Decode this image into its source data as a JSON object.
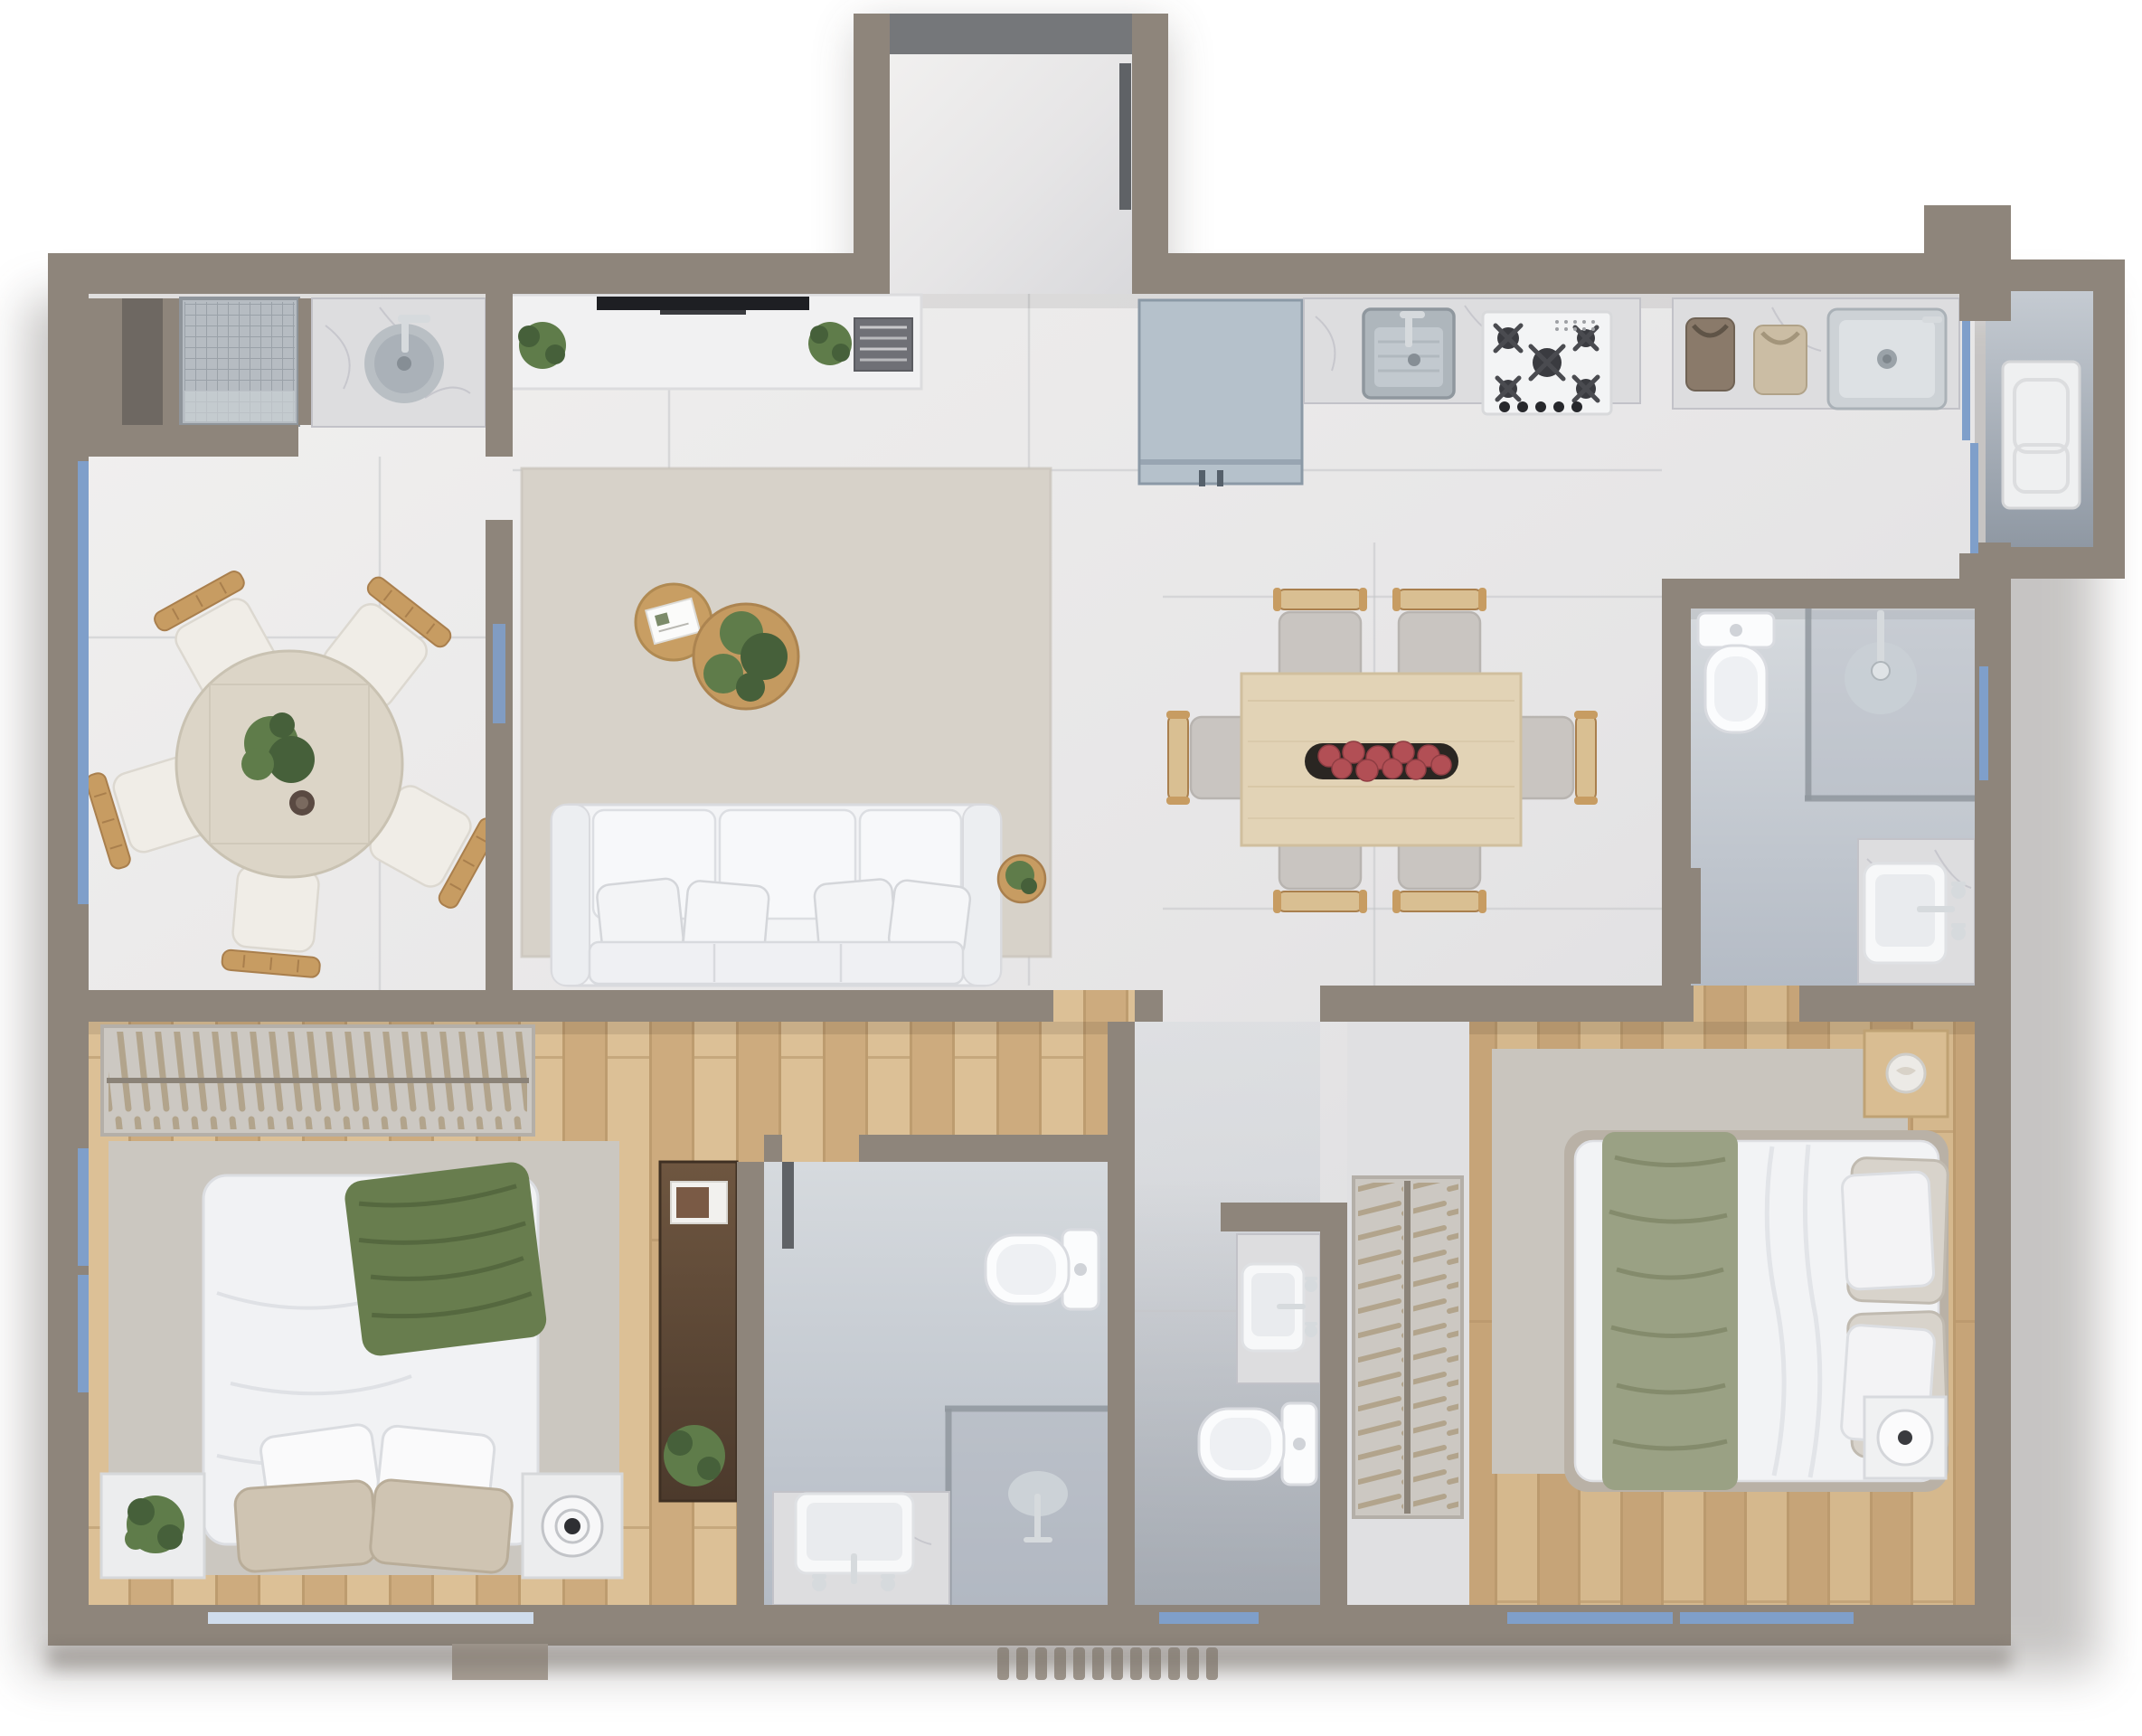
{
  "meta": {
    "title": "3D apartment floor plan – top-down architectural render",
    "view": "top-down",
    "style": "photorealistic 3d render, no text labels"
  },
  "palette": {
    "bg": "#ffffff",
    "shadow": "#55504b",
    "wall": "#8e857b",
    "wallLight": "#a59c92",
    "wallDark": "#756d66",
    "grout": "#c6c7ca",
    "tileA": "#f1f0ef",
    "tileB": "#d9d9dc",
    "bathA": "#d6dade",
    "bathB": "#b4bbc5",
    "balcA": "#c5cbd2",
    "balcB": "#8f98a3",
    "marble": "#dddddf",
    "marbleVein": "#c2c2c8",
    "wood": "#cdab7e",
    "woodLight": "#dcc096",
    "woodLine": "#b08f63",
    "wood2": "#c6a478",
    "wood2Light": "#d5b88d",
    "darkWoodA": "#6e5640",
    "darkWoodB": "#4c3a2c",
    "rugLiving": "#d7d2c9",
    "rugBed": "#cbc7c0",
    "rugMaster": "#c9c5be",
    "furnWhite": "#f3f4f6",
    "furnShadow": "#d9dade",
    "chrome": "#d6dadd",
    "glass": "#8f969e",
    "windowBlue": "#7f9fca",
    "windowPale": "#cfdcec",
    "plantGreen": "#5f7c4a",
    "plantDark": "#46603a",
    "throwGreen": "#687d4e",
    "throwSage": "#9aa184",
    "pillowBeige": "#cfc4b2",
    "woodFurn": "#c79c62",
    "woodFurnDark": "#a97f4d",
    "tableRound": "#dcd5c7",
    "tableWood": "#e2d3b6",
    "chairSeat": "#c9c5c1",
    "chairBack": "#d9bf92",
    "blueCab": "#b5c1cb",
    "blueCabDark": "#8b99a6",
    "steelA": "#cdd2d6",
    "steelB": "#9aa2a8",
    "tvBlack": "#1e1f23",
    "bookGray": "#6f7076",
    "fruitRed": "#b24f55",
    "matTeeth": "#9c948a",
    "grateFill": "#b6bcc2",
    "grateLine": "#9aa1a8",
    "hanger": "#b2a48c",
    "rackFrame": "#ccc8c2",
    "rail": "#8b8378",
    "toiletWhite": "#fbfcfd",
    "doorLeaf": "#5f6266",
    "threshold": "#75777a"
  },
  "floor_plan": {
    "rooms": [
      {
        "id": "laundry-niche",
        "name": "Laundry / service niche",
        "floor": "porcelain tile",
        "fixtures": [
          "wall-niche",
          "floor-grate",
          "marble-counter",
          "round-metal-washbasin",
          "faucet"
        ]
      },
      {
        "id": "dining-left",
        "name": "Left dining room",
        "floor": "porcelain tile",
        "fixtures": [
          "round-travertine-table",
          "5-wood-chairs",
          "centerpiece-plant",
          "cup"
        ],
        "windows": [
          "full-height-left-window"
        ]
      },
      {
        "id": "living-room",
        "name": "Living room",
        "floor": "porcelain tile",
        "fixtures": [
          "media-console",
          "flat-tv",
          "2-plants",
          "book-stack",
          "area-rug",
          "2-round-coffee-tables",
          "magazine",
          "plant",
          "3-seat-white-sofa",
          "4-throw-pillows",
          "side-table-plant"
        ]
      },
      {
        "id": "entry-hall",
        "name": "Entry hall (top protrusion)",
        "floor": "porcelain tile",
        "fixtures": [
          "dark-threshold",
          "open-door-leaf"
        ]
      },
      {
        "id": "kitchen",
        "name": "Kitchen",
        "floor": "porcelain tile",
        "fixtures": [
          "blue-gray-cabinet-fridge",
          "marble-counter",
          "square-undermount-sink",
          "faucet",
          "5-burner-gas-cooktop"
        ]
      },
      {
        "id": "service-area",
        "name": "Service / laundry counter",
        "floor": "porcelain tile",
        "fixtures": [
          "2-fabric-bags",
          "stainless-steel-sink",
          "sliding-glass-door"
        ]
      },
      {
        "id": "service-balcony",
        "name": "Service balcony",
        "floor": "concrete gray",
        "fixtures": [
          "white-utility-table"
        ]
      },
      {
        "id": "dining-right",
        "name": "Main dining area",
        "floor": "porcelain tile",
        "fixtures": [
          "rect-wood-table",
          "6-chairs",
          "black-tray-with-red-fruit"
        ]
      },
      {
        "id": "master-bath",
        "name": "Master bathroom",
        "floor": "blue-gray tile",
        "fixtures": [
          "toilet",
          "glass-shower",
          "rain-shower-head",
          "marble-vanity",
          "vessel-sink",
          "faucet-handles"
        ],
        "windows": [
          "right-wall-window"
        ]
      },
      {
        "id": "bedroom-1",
        "name": "Bedroom 1",
        "floor": "wood planks",
        "fixtures": [
          "open-wardrobe-rack",
          "double-bed",
          "green-throw",
          "4-pillows",
          "rug",
          "2-nightstands",
          "potted-plant",
          "round-speaker",
          "dark-wood-cabinet",
          "framed-art",
          "floor-plant"
        ],
        "windows": [
          "2-left-windows",
          "bottom-window"
        ]
      },
      {
        "id": "bathroom-1",
        "name": "Bathroom 1",
        "floor": "blue-gray tile",
        "fixtures": [
          "toilet",
          "glass-shower",
          "shower-head",
          "marble-vanity",
          "vessel-sink"
        ]
      },
      {
        "id": "corridor",
        "name": "Entry corridor",
        "floor": "porcelain tile",
        "fixtures": [
          "ribbed-entry-mat",
          "bottom-window"
        ]
      },
      {
        "id": "wc",
        "name": "Guest WC",
        "floor": "blue-gray tile",
        "fixtures": [
          "marble-counter",
          "vessel-sink",
          "toilet"
        ]
      },
      {
        "id": "master-closet",
        "name": "Master closet",
        "floor": "porcelain tile",
        "fixtures": [
          "open-clothes-rack"
        ]
      },
      {
        "id": "master-bedroom",
        "name": "Master bedroom",
        "floor": "wood planks",
        "fixtures": [
          "double-bed",
          "sage-throw",
          "4-pillows",
          "rug",
          "wood-nightstand",
          "round-tray",
          "white-speaker-table"
        ],
        "windows": [
          "2-bottom-windows"
        ]
      }
    ],
    "walls": {
      "exterior_thickness_px": 45,
      "interior_thickness_px": 30,
      "material_color_key": "wall"
    }
  }
}
